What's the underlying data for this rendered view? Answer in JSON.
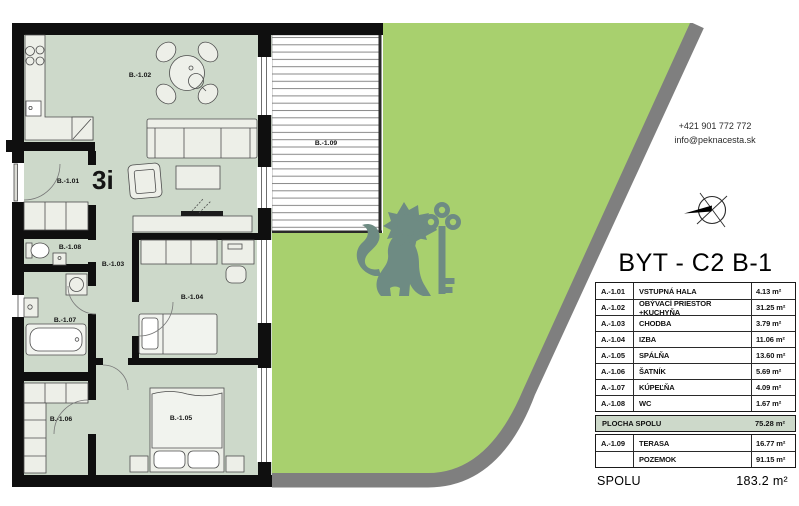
{
  "contact": {
    "phone": "+421 901 772 772",
    "email": "info@peknacesta.sk"
  },
  "unit": {
    "title": "BYT - C2 B-1",
    "type_badge": "3i"
  },
  "rooms_table": {
    "rows": [
      {
        "code": "A.-1.01",
        "name": "VSTUPNÁ HALA",
        "area": "4.13 m²"
      },
      {
        "code": "A.-1.02",
        "name": "OBÝVACÍ PRIESTOR +KUCHYŇA",
        "area": "31.25 m²"
      },
      {
        "code": "A.-1.03",
        "name": "CHODBA",
        "area": "3.79 m²"
      },
      {
        "code": "A.-1.04",
        "name": "IZBA",
        "area": "11.06 m²"
      },
      {
        "code": "A.-1.05",
        "name": "SPÁLŇA",
        "area": "13.60 m²"
      },
      {
        "code": "A.-1.06",
        "name": "ŠATNÍK",
        "area": "5.69 m²"
      },
      {
        "code": "A.-1.07",
        "name": "KÚPEĽŇA",
        "area": "4.09 m²"
      },
      {
        "code": "A.-1.08",
        "name": "WC",
        "area": "1.67 m²"
      }
    ],
    "total": {
      "label": "PLOCHA SPOLU",
      "area": "75.28 m²"
    },
    "outdoor": [
      {
        "code": "A.-1.09",
        "name": "TERASA",
        "area": "16.77 m²"
      },
      {
        "code": "",
        "name": "POZEMOK",
        "area": "91.15 m²"
      }
    ],
    "grand_total": {
      "label": "SPOLU",
      "area": "183.2 m²"
    }
  },
  "plan_labels": {
    "hall": "B.-1.01",
    "living": "B.-1.02",
    "corridor": "B.-1.03",
    "room": "B.-1.04",
    "bedroom": "B.-1.05",
    "closet": "B.-1.06",
    "bath": "B.-1.07",
    "wc": "B.-1.08",
    "terrace": "B.-1.09"
  },
  "colors": {
    "lawn_green": "#a8d06e",
    "room_fill": "#cdd9ca",
    "pavement_gray": "#7f7f7f",
    "wall_black": "#0f0f0f",
    "watermark_teal": "#6e8b83"
  }
}
